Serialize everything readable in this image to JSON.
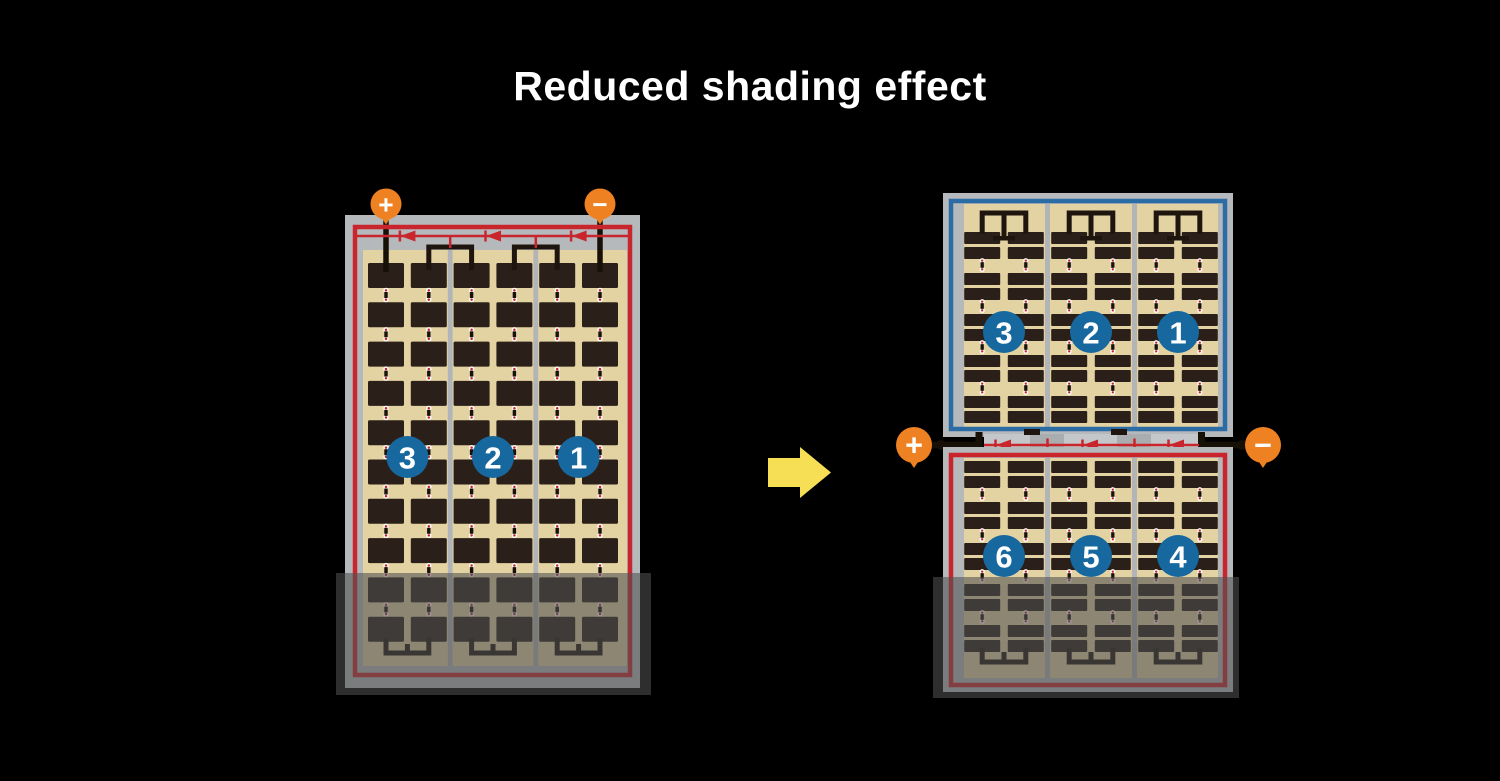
{
  "title": "Reduced shading effect",
  "panels": {
    "left": {
      "name": "conventional full-cell module",
      "terminals": {
        "positive": "+",
        "negative": "−"
      },
      "strings": [
        "3",
        "2",
        "1"
      ],
      "diode_count": 3,
      "columns": 6,
      "rows": 10,
      "shaded_bottom": true
    },
    "right": {
      "name": "half-cut split module",
      "terminals": {
        "positive": "+",
        "negative": "−"
      },
      "top_strings": [
        "3",
        "2",
        "1"
      ],
      "bottom_strings": [
        "6",
        "5",
        "4"
      ],
      "diode_count": 3,
      "columns": 6,
      "shaded_bottom": true
    }
  },
  "colors": {
    "background": "#000000",
    "frame_gray": "#b6b9bc",
    "cell_sheet_tan": "#e3d2a2",
    "cell_dark": "#2a2019",
    "busbar_black": "#1d150e",
    "wire_black": "#161007",
    "border_red": "#c8262c",
    "border_blue": "#2c6ca4",
    "badge_blue": "#17689e",
    "terminal_orange": "#ee8122",
    "arrow_yellow": "#f7df55",
    "junction_gray": "#c4c7c9",
    "divider_gray": "#b2b5b8",
    "connector_white": "#ffffff",
    "connector_red": "#c8262c",
    "shade_overlay": "rgba(80,80,80,0.58)"
  }
}
